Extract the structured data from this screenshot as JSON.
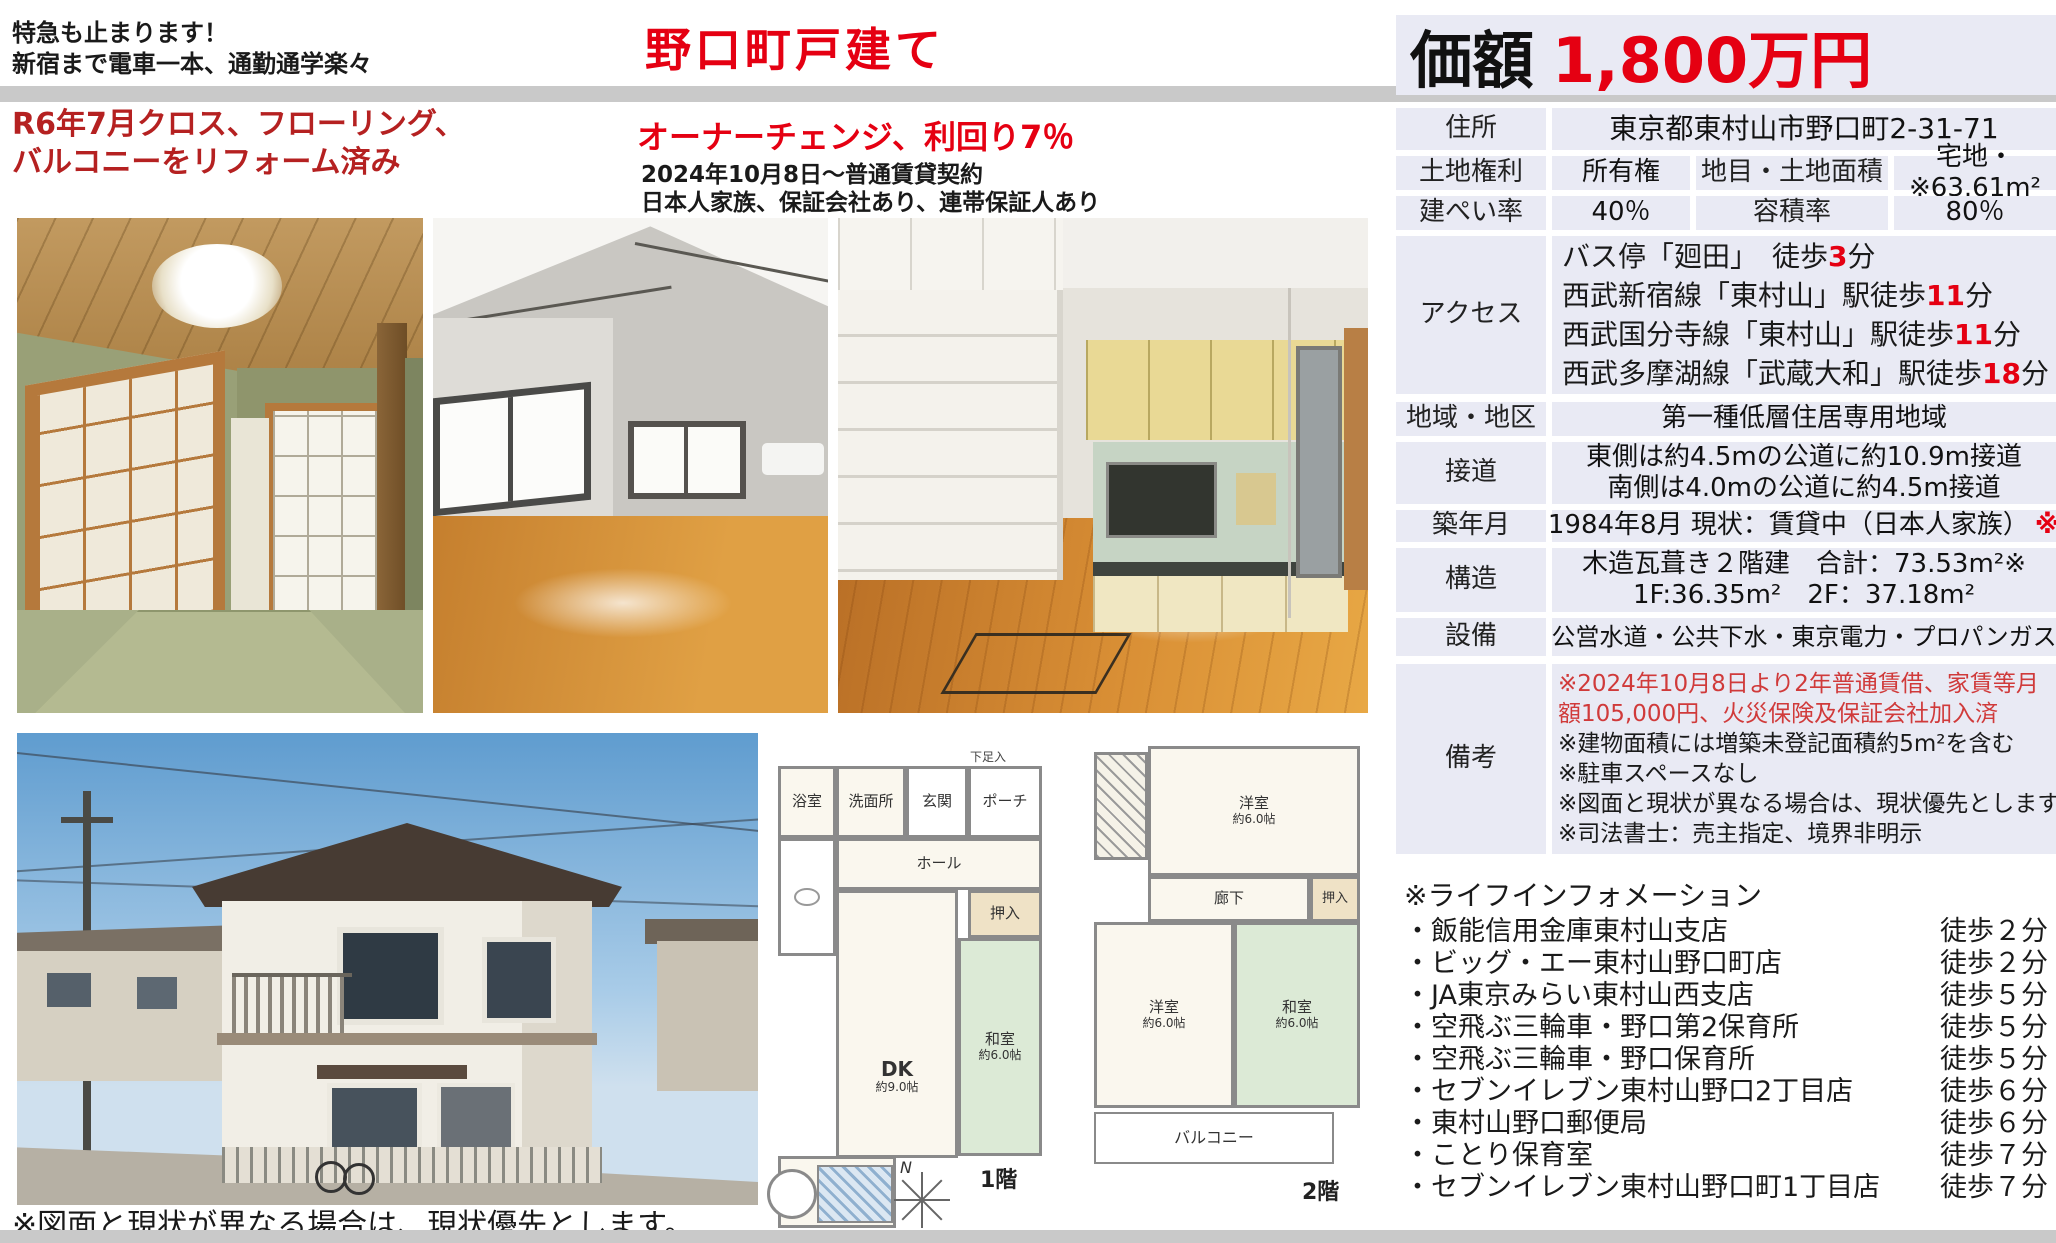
{
  "header": {
    "top_left_line1": "特急も止まります！",
    "top_left_line2": "新宿まで電車一本、通勤通学楽々",
    "title": "野口町戸建て",
    "promo_line1": "R6年7月クロス、フローリング、",
    "promo_line2": "バルコニーをリフォーム済み",
    "owner_change": "オーナーチェンジ、利回り7％",
    "contract_line1": "2024年10月8日～普通賃貸契約",
    "contract_line2": "日本人家族、保証会社あり、連帯保証人あり"
  },
  "price": {
    "label": "価額",
    "value": "1,800万円"
  },
  "table": {
    "address": {
      "label": "住所",
      "value": "東京都東村山市野口町2-31-71"
    },
    "land_right": {
      "label": "土地権利",
      "value": "所有権",
      "label2": "地目・土地面積",
      "value2": "宅地・※63.61m²"
    },
    "bcr": {
      "label": "建ぺい率",
      "value": "40％",
      "label2": "容積率",
      "value2": "80％"
    },
    "access": {
      "label": "アクセス",
      "lines": [
        {
          "pre": "バス停「廻田」　徒歩",
          "num": "3",
          "post": "分"
        },
        {
          "pre": "西武新宿線「東村山」駅徒歩",
          "num": "11",
          "post": "分"
        },
        {
          "pre": "西武国分寺線「東村山」駅徒歩",
          "num": "11",
          "post": "分"
        },
        {
          "pre": "西武多摩湖線「武蔵大和」駅徒歩",
          "num": "18",
          "post": "分"
        }
      ]
    },
    "zone": {
      "label": "地域・地区",
      "value": "第一種低層住居専用地域"
    },
    "road": {
      "label": "接道",
      "line1": "東側は約4.5mの公道に約10.9m接道",
      "line2": "南側は4.0mの公道に約4.5m接道"
    },
    "built": {
      "label": "築年月",
      "value": "1984年8月 現状：賃貸中（日本人家族）",
      "mark": "※"
    },
    "structure": {
      "label": "構造",
      "line1": "木造瓦葺き２階建　合計：73.53m²※",
      "line2": "1F:36.35m²　2F：37.18m²"
    },
    "facilities": {
      "label": "設備",
      "value": "公営水道・公共下水・東京電力・プロパンガス"
    },
    "notes": {
      "label": "備考",
      "red_lines": [
        "※2024年10月8日より2年普通賃借、家賃等月",
        "額105,000円、火災保険及保証会社加入済"
      ],
      "black_lines": [
        "※建物面積には増築未登記面積約5m²を含む",
        "※駐車スペースなし",
        "※図面と現状が異なる場合は、現状優先とします。",
        "※司法書士：売主指定、境界非明示"
      ]
    }
  },
  "life_info": {
    "title": "※ライフインフォメーション",
    "items": [
      {
        "name": "・飯能信用金庫東村山支店",
        "time": "徒歩２分"
      },
      {
        "name": "・ビッグ・エー東村山野口町店",
        "time": "徒歩２分"
      },
      {
        "name": "・JA東京みらい東村山西支店",
        "time": "徒歩５分"
      },
      {
        "name": "・空飛ぶ三輪車・野口第2保育所",
        "time": "徒歩５分"
      },
      {
        "name": "・空飛ぶ三輪車・野口保育所",
        "time": "徒歩５分"
      },
      {
        "name": "・セブンイレブン東村山野口2丁目店",
        "time": "徒歩６分"
      },
      {
        "name": "・東村山野口郵便局",
        "time": "徒歩６分"
      },
      {
        "name": "・ことり保育室",
        "time": "徒歩７分"
      },
      {
        "name": "・セブンイレブン東村山野口町1丁目店",
        "time": "徒歩７分"
      }
    ]
  },
  "floor_plan_1f": {
    "bath": "浴室",
    "wash": "洗面所",
    "entrance": "玄関",
    "porch": "ポーチ",
    "shoe": "下足入",
    "hall": "ホール",
    "oshiire": "押入",
    "washitsu": "和室",
    "washitsu_size": "約6.0帖",
    "dk": "DK",
    "dk_size": "約9.0帖",
    "floor_label": "1階",
    "compass": "N"
  },
  "floor_plan_2f": {
    "yoshitsu_top": "洋室",
    "yoshitsu_top_size": "約6.0帖",
    "rouka": "廊下",
    "oshiire": "押入",
    "yoshitsu": "洋室",
    "yoshitsu_size": "約6.0帖",
    "washitsu": "和室",
    "washitsu_size": "約6.0帖",
    "balcony": "バルコニー",
    "floor_label": "2階"
  },
  "caption": "※図面と現状が異なる場合は、現状優先とします。",
  "colors": {
    "accent_red": "#e50012",
    "promo_red": "#b52121",
    "note_red": "#d03a3a",
    "table_bg": "#e9eaf4",
    "bar_gray": "#c9c9c9"
  }
}
